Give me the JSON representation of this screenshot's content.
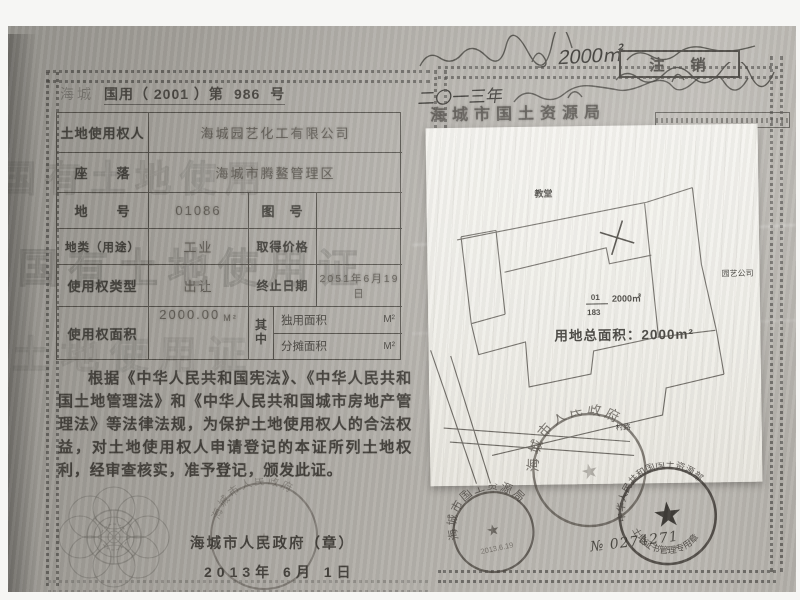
{
  "colors": {
    "paper": "#b0ada7",
    "ink": "#403e39",
    "white_sheet": "#f2f1ec",
    "stamp": "#49443e"
  },
  "certificate": {
    "header": {
      "prefix": "海城",
      "main": "国用（ 2001 ）第",
      "number": "986",
      "suffix": "号"
    },
    "table": {
      "r1": {
        "label": "土地使用权人",
        "value": "海城园艺化工有限公司"
      },
      "r2": {
        "label": "座　　落",
        "value": "海城市腾鳌管理区"
      },
      "r3": {
        "label": "地　　号",
        "value": "01086",
        "label2": "图　号",
        "value2": ""
      },
      "r4": {
        "label": "地类（用途）",
        "value": "工业",
        "label2": "取得价格",
        "value2": ""
      },
      "r5": {
        "label": "使用权类型",
        "value": "出让",
        "label2": "终止日期",
        "value2": "2051年6月19日"
      },
      "r6": {
        "label": "使用权面积",
        "value": "2000.00",
        "unit": "M²",
        "middle": "其中",
        "sub1_label": "独用面积",
        "sub1_unit": "M²",
        "sub2_label": "分摊面积",
        "sub2_unit": "M²"
      }
    },
    "body_text": "根据《中华人民共和国宪法》、《中华人民共和国土地管理法》和《中华人民共和国城市房地产管理法》等法律法规，为保护土地使用权人的合法权益，对土地使用权人申请登记的本证所列土地权利，经审查核实，准予登记，颁发此证。",
    "issuer": {
      "name": "海城市人民政府（章）",
      "date": "2013年 6月 1日"
    },
    "watermark": {
      "row1": "国有土地使用证",
      "row2": "国有土地使用",
      "row3": "土地使用证"
    }
  },
  "right_page": {
    "cancel_box": "注销",
    "agency": "海城市国土资源局",
    "handwritten_area": "2000㎡",
    "handwritten_year": "二〇一三年"
  },
  "site_plan": {
    "building_label": "教堂",
    "neighbor_label": "园艺公司",
    "road_label": "村路",
    "parcel_no": "01",
    "map_no": "183",
    "parcel_area": "2000㎡",
    "total_area": "用地总面积：2000m²"
  },
  "stamps": {
    "bureau": {
      "arc": "海城市国土资源局",
      "date": "2013.6.19"
    },
    "government": {
      "arc": "海城市人民政府"
    },
    "ministry": {
      "arc_top": "中华人民共和国国土资源部",
      "arc_bottom": "土地证书管理专用章",
      "serial": "№ 0274271"
    }
  }
}
